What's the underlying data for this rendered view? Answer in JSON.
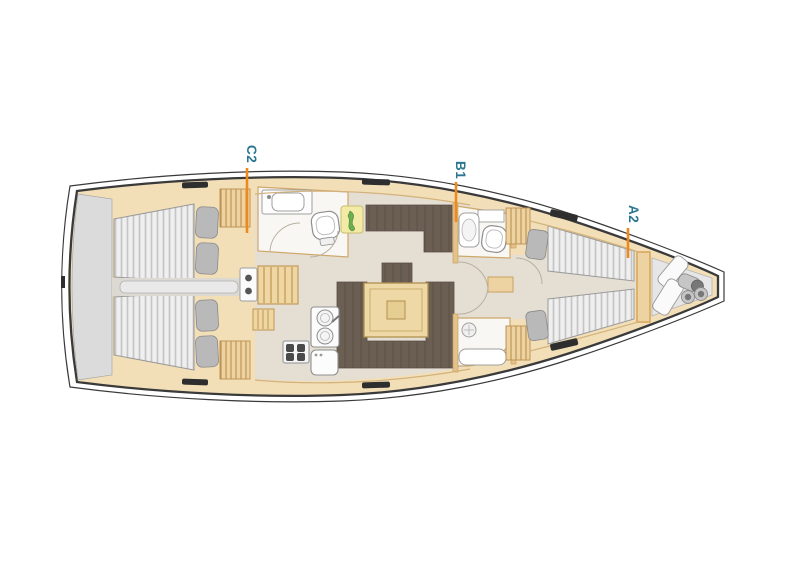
{
  "diagram": {
    "type": "sailboat-interior-floorplan",
    "labels": [
      {
        "text": "C2"
      },
      {
        "text": "B1"
      },
      {
        "text": "A2"
      }
    ],
    "colors": {
      "label_text": "#2b7690",
      "leader_line": "#ee8a1d",
      "hull_outline": "#3a3a3a",
      "wood": "#f2dfb8",
      "wood_trim": "#c89e62",
      "floor": "#e4ded3",
      "upholstery": "#6b5e52",
      "mattress": "#efefef",
      "mattress_stripe": "#c5c5c5",
      "pillow": "#b9b9b9",
      "platform": "#dbdbdb",
      "fixture_white": "#fbfbfb",
      "art_yellow": "#f3eaa6"
    }
  }
}
